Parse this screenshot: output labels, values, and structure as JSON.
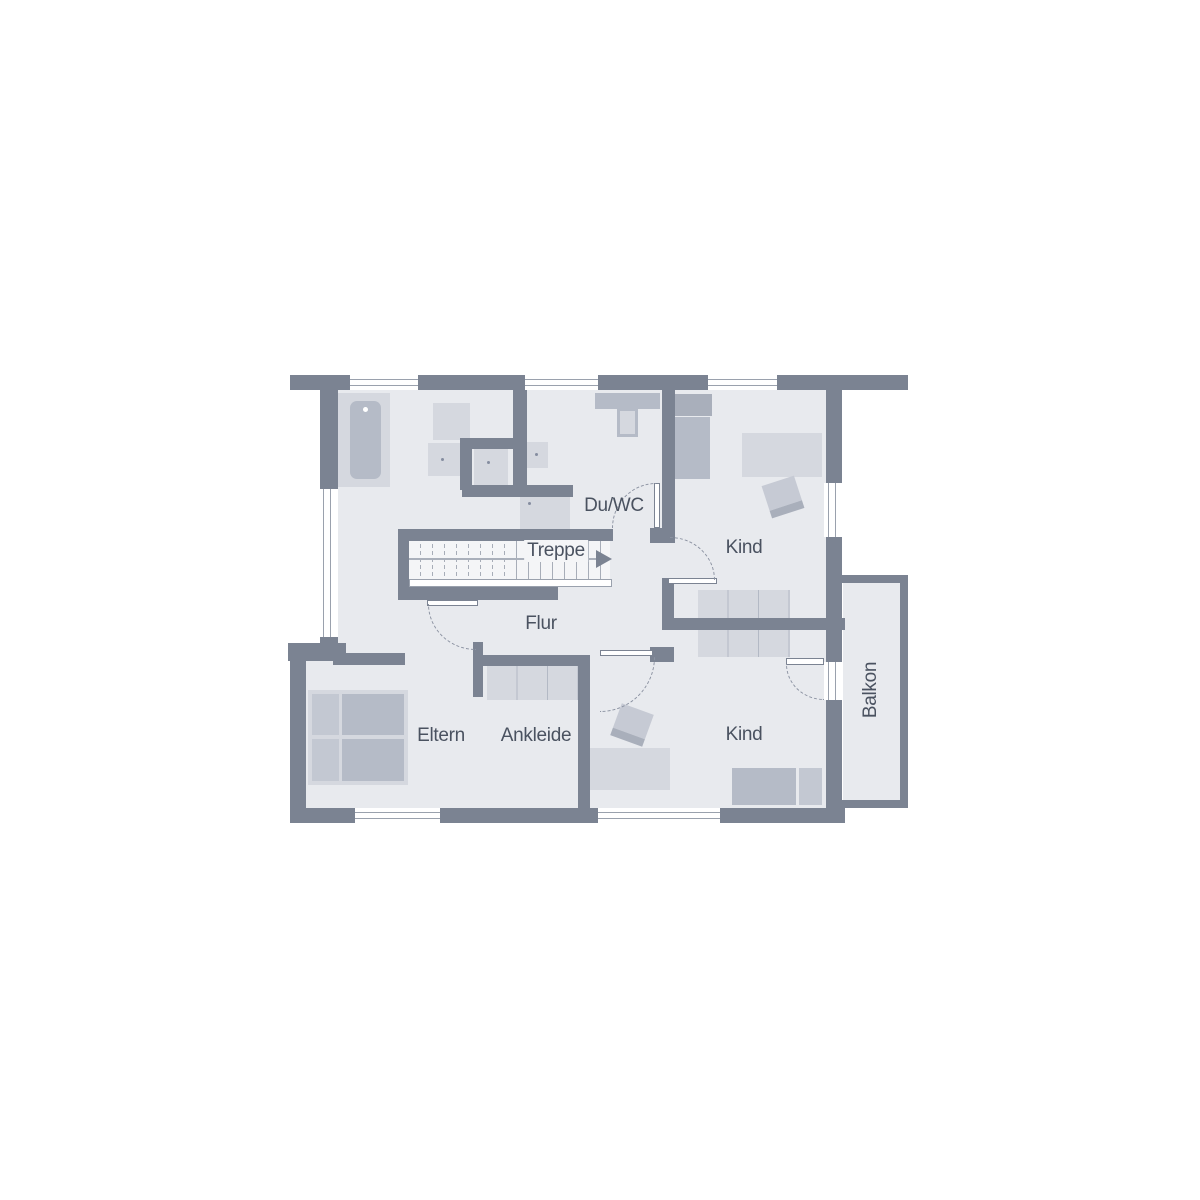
{
  "rooms": {
    "shower_wc": "Du/WC",
    "stairs": "Treppe",
    "hallway": "Flur",
    "child_top": "Kind",
    "child_bottom": "Kind",
    "parents": "Eltern",
    "dressing": "Ankleide",
    "balcony": "Balkon"
  },
  "colors": {
    "wall": "#7b8392",
    "floor": "#e8eaee",
    "floor_stairs": "#f4f5f7",
    "furniture_light": "#d5d8df",
    "furniture_medium": "#b5bbc7",
    "furniture_dark": "#a9afbb",
    "furniture_pillow": "#c3c8d2",
    "text": "#4a5260",
    "line": "#9aa1ad",
    "arc": "#8c93a2"
  }
}
